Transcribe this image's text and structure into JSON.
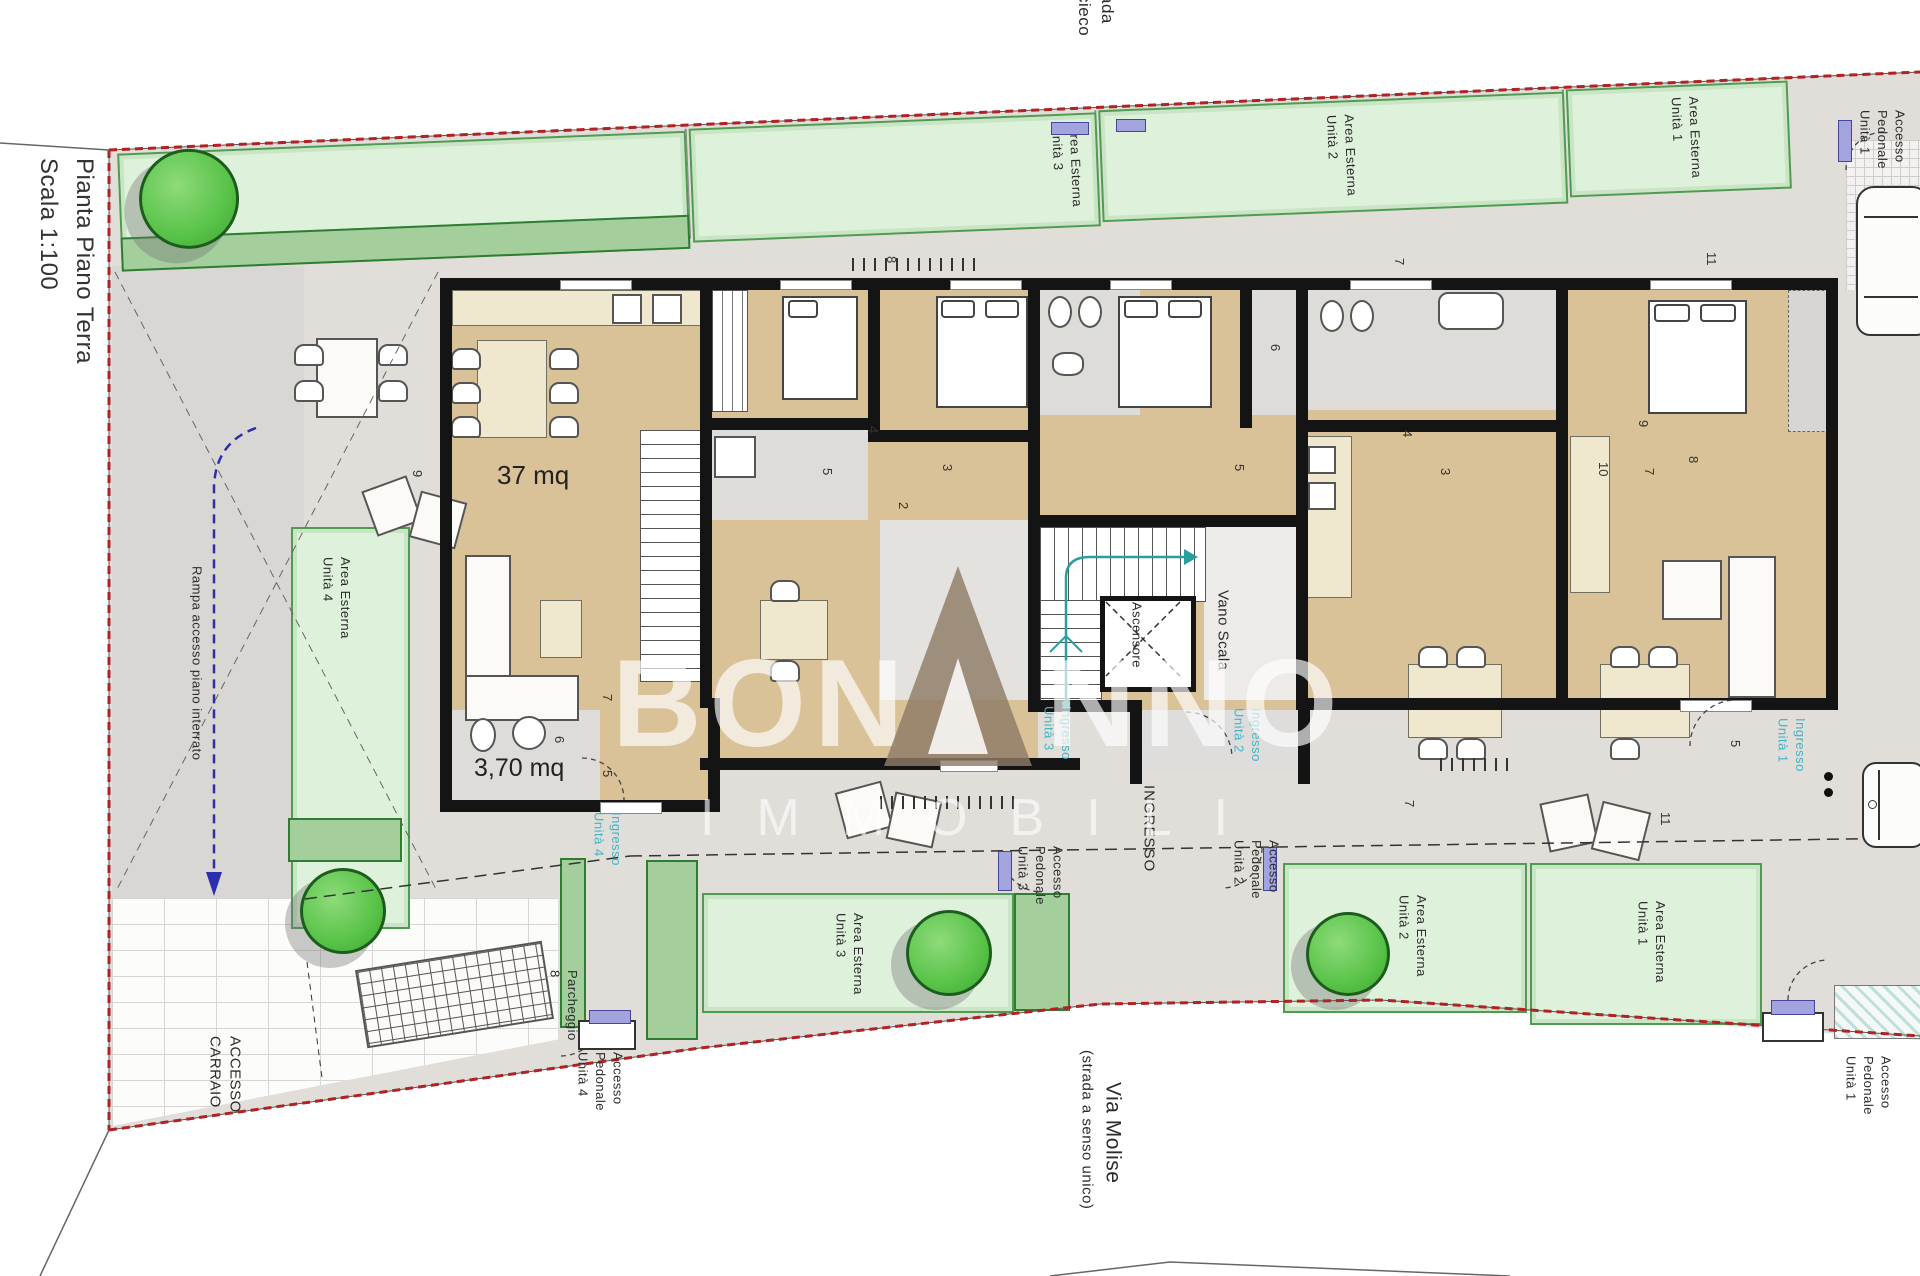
{
  "title": {
    "line1": "Pianta Piano Terra",
    "line2": "Scala 1:100"
  },
  "streets": {
    "top_fragment": "ada\ncieco",
    "bottom_name": "Via Molise",
    "bottom_note": "(strada a senso unico)"
  },
  "watermark": {
    "brand_left": "BON",
    "brand_right": "NNO",
    "brand_sub": "IMMOBILI",
    "brand_full": "BONANNO IMMOBILI"
  },
  "core": {
    "stairwell": "Vano Scala",
    "elevator": "Ascensore",
    "entrance": "INGRESSO"
  },
  "rooms": {
    "living_area": "37 mq",
    "bath_area": "3,70 mq"
  },
  "gardens": {
    "top": [
      "Area Esterna\nUnità 3",
      "Area Esterna\nUnità 2",
      "Area Esterna\nUnità 1"
    ],
    "bottom": [
      "Area Esterna\nUnità 4",
      "Area Esterna\nUnità 3",
      "Area Esterna\nUnità 2",
      "Area Esterna\nUnità 1"
    ]
  },
  "access": {
    "carraio": "ACCESSO\nCARRAIO",
    "rampa": "Rampa accesso piano interrato",
    "parcheggio": "Parcheggio\n8",
    "pedonale_1_top": "Accesso\nPedonale\nUnità 1",
    "pedonale_1": "Accesso\nPedonale\nUnità 1",
    "pedonale_2": "Accesso\nPedonale\nUnità 2",
    "pedonale_3": "Accesso\nPedonale\nUnità 3",
    "pedonale_4": "Accesso\nPedonale\nUnità 4"
  },
  "entrances": [
    "Ingresso\nUnità 1",
    "Ingresso\nUnità 2",
    "Ingresso\nUnità 3",
    "Ingresso\nUnità 4"
  ],
  "dims": [
    "8",
    "7",
    "11",
    "9",
    "4",
    "5",
    "3",
    "2",
    "6",
    "5",
    "3",
    "4",
    "10",
    "9",
    "8",
    "7",
    "7",
    "6",
    "5",
    "7",
    "11",
    "5"
  ],
  "colors": {
    "boundary_red": "#b22222",
    "entrance_cyan": "#3fb5c8",
    "floor_tan": "#d9c198",
    "garden_green": "#def1da",
    "hedge_green": "#a4cf9c",
    "tree_green": "#57c247",
    "gate_purple": "#a3a3de",
    "wall_black": "#141414"
  }
}
